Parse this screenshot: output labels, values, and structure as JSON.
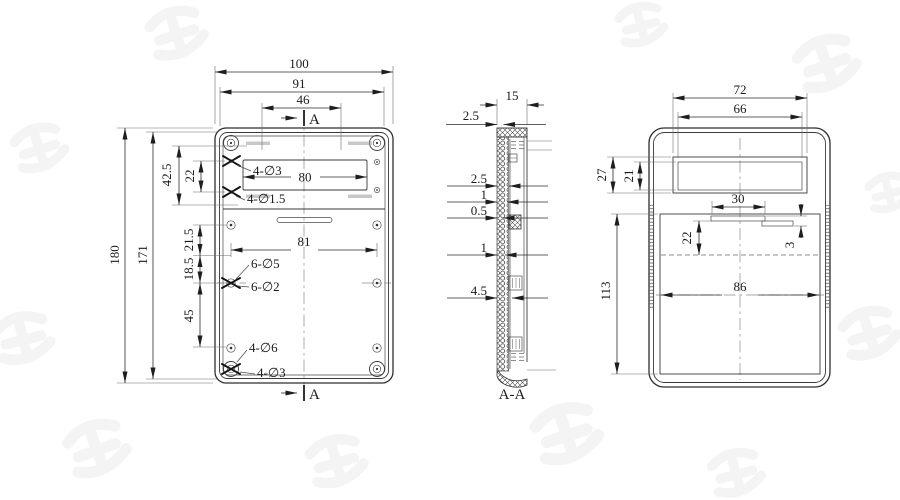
{
  "drawing": {
    "section_marker": "A",
    "section_label": "A-A",
    "colors": {
      "ink": "#2b2b2b",
      "watermark": "#ececec"
    },
    "front": {
      "overall_width": "100",
      "inner_width": "91",
      "slot_spacing": "46",
      "overall_height": "180",
      "inner_height": "171",
      "top_offset": "42.5",
      "pilot_pitch": "22",
      "window_width": "80",
      "mid_a": "21.5",
      "mid_b": "18.5",
      "hole_span": "81",
      "mid_c": "45",
      "callout_top_a": "4-∅3",
      "callout_top_b": "4-∅1.5",
      "callout_mid_a": "6-∅5",
      "callout_mid_b": "6-∅2",
      "callout_bot_a": "4-∅6",
      "callout_bot_b": "4-∅3"
    },
    "section": {
      "depth": "15",
      "lip": "2.5",
      "wall_a": "2.5",
      "wall_b": "1",
      "wall_c": "0.5",
      "wall_d": "1",
      "wall_e": "4.5"
    },
    "side": {
      "window_outer_width": "72",
      "window_inner_width": "66",
      "window_outer_height": "27",
      "window_inner_height": "21",
      "tab_width": "30",
      "tab_offset": "22",
      "tab_thickness": "3",
      "cavity_height": "113",
      "cavity_width": "86"
    }
  }
}
